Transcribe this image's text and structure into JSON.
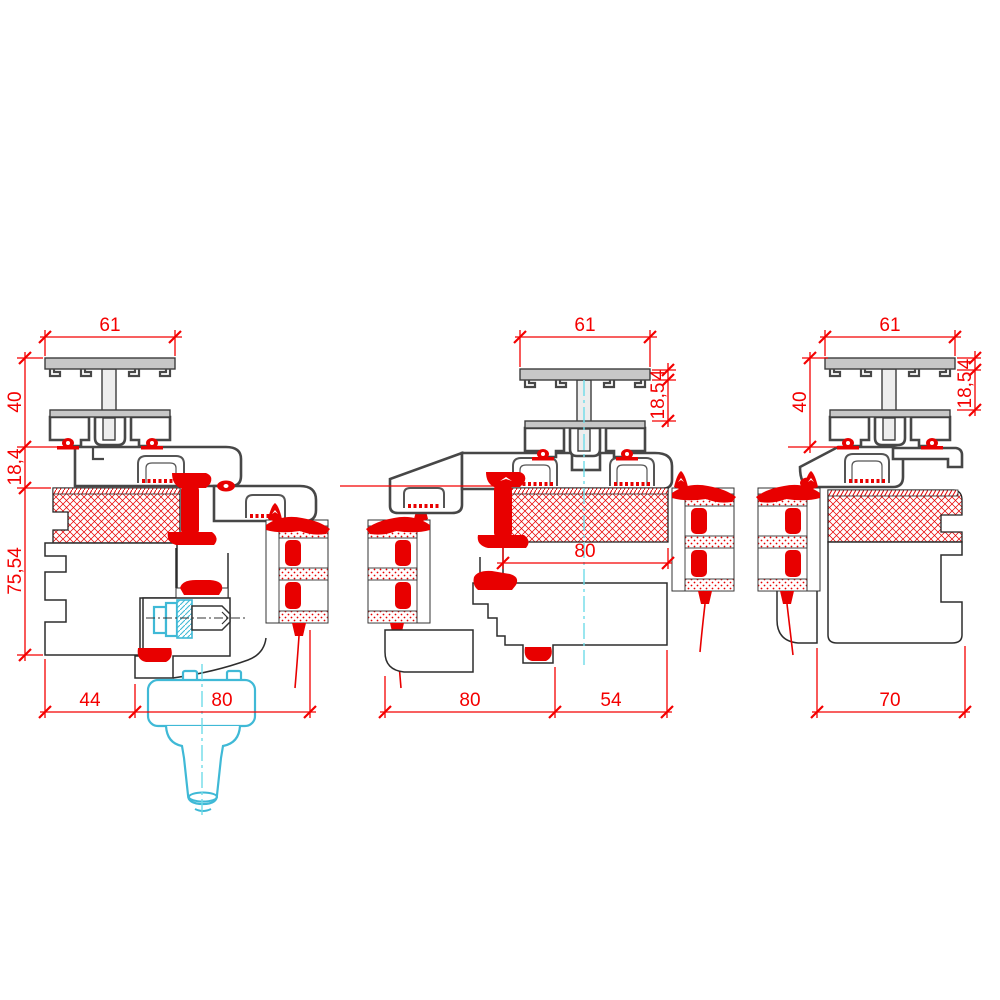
{
  "drawing": {
    "type": "window-profile-cross-sections",
    "colors": {
      "dimension": "#f40000",
      "gasket": "#e80000",
      "hatch": "#e80000",
      "aluminum_fill": "#c7c7c7",
      "profile_outline": "#474747",
      "wood_outline": "#2d2d2d",
      "handle_cyan": "#3fb9d6",
      "centerline_cyan": "#6fdce8"
    },
    "sections": {
      "left": {
        "name": "left-detail"
      },
      "middle": {
        "name": "middle-detail"
      },
      "right": {
        "name": "right-detail"
      }
    },
    "dims": {
      "left": {
        "width_top": "61",
        "height_profile": "40",
        "height_gap": "18,4",
        "height_frame": "75,54",
        "width_offset": "44",
        "width_sash": "80"
      },
      "middle": {
        "width_top": "61",
        "thickness_cap": "4",
        "height_cap": "18,5",
        "width_glass": "80",
        "width_sash": "80",
        "width_overlap": "54"
      },
      "right": {
        "width_top": "61",
        "height_profile": "40",
        "thickness_cap": "4",
        "height_cap": "18,5",
        "width_frame": "70"
      }
    }
  }
}
